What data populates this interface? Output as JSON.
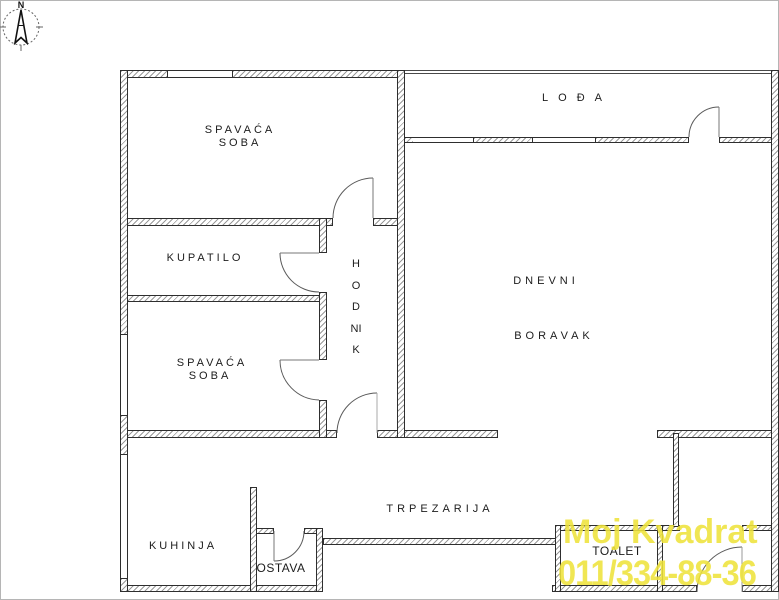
{
  "compass": {
    "label": "N"
  },
  "rooms": {
    "bedroom_top": {
      "line1": "SPAVAĆA",
      "line2": "SOBA"
    },
    "loggia": {
      "label": "LOĐA"
    },
    "bathroom": {
      "label": "KUPATILO"
    },
    "hallway": {
      "label": "HODNIK"
    },
    "bedroom_left": {
      "line1": "SPAVAĆA",
      "line2": "SOBA"
    },
    "living_room": {
      "line1": "DNEVNI",
      "line2": "BORAVAK"
    },
    "dining_room": {
      "label": "TRPEZARIJA"
    },
    "kitchen": {
      "label": "KUHINJA"
    },
    "pantry": {
      "label": "OSTAVA"
    },
    "toilet": {
      "label": "TOALET"
    }
  },
  "watermark": {
    "line1": "Moj Kvadrat",
    "line2": "011/334-88-36",
    "color": "#efe33c"
  }
}
